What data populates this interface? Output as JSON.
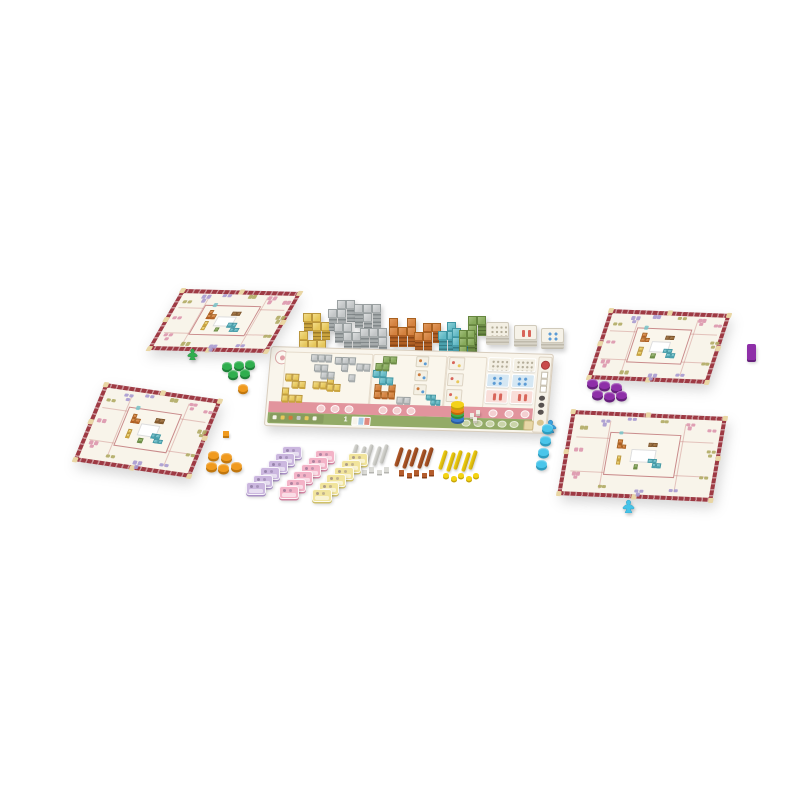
{
  "scene": {
    "background": "#ffffff"
  },
  "palette": {
    "gold": {
      "top": "#e7c75a",
      "light": "#f2dd8a",
      "edge": "#bb973d",
      "s1": "#caa43e",
      "s2": "#9a7a2a"
    },
    "gray": {
      "top": "#c3c6c7",
      "light": "#dcdedf",
      "edge": "#9aa0a1",
      "s1": "#a6abac",
      "s2": "#82888a"
    },
    "orange": {
      "top": "#d3813f",
      "light": "#e29a5e",
      "edge": "#a8601f",
      "s1": "#b05f24",
      "s2": "#8a4718"
    },
    "teal": {
      "top": "#62b9c5",
      "light": "#8ed0d8",
      "edge": "#3f96a3",
      "s1": "#4aa0ad",
      "s2": "#357d88"
    },
    "green": {
      "top": "#86a95b",
      "light": "#a3bf7d",
      "edge": "#66863f",
      "s1": "#6d8c46",
      "s2": "#536e33"
    },
    "brown": {
      "top": "#9a6b3a",
      "light": "#b08452",
      "edge": "#7a5026",
      "s1": "#83592c",
      "s2": "#6a4522"
    },
    "white": {
      "top": "#f2eee2",
      "light": "#faf7ef",
      "edge": "#d6cfbc",
      "s1": "#ddd6c4",
      "s2": "#c4bca8"
    }
  },
  "shapes": {
    "I2": [
      [
        0,
        0
      ],
      [
        1,
        0
      ]
    ],
    "I3": [
      [
        0,
        0
      ],
      [
        1,
        0
      ],
      [
        2,
        0
      ]
    ],
    "O1": [
      [
        0,
        0
      ]
    ],
    "V2": [
      [
        0,
        0
      ],
      [
        0,
        1
      ]
    ],
    "O4": [
      [
        0,
        0
      ],
      [
        1,
        0
      ],
      [
        0,
        1
      ],
      [
        1,
        1
      ]
    ],
    "S4": [
      [
        0,
        0
      ],
      [
        1,
        0
      ],
      [
        1,
        1
      ],
      [
        2,
        1
      ]
    ],
    "Z4": [
      [
        1,
        0
      ],
      [
        2,
        0
      ],
      [
        0,
        1
      ],
      [
        1,
        1
      ]
    ],
    "L4": [
      [
        0,
        0
      ],
      [
        0,
        1
      ],
      [
        1,
        1
      ],
      [
        2,
        1
      ]
    ],
    "J4": [
      [
        0,
        0
      ],
      [
        1,
        0
      ],
      [
        2,
        0
      ],
      [
        2,
        1
      ]
    ],
    "T4": [
      [
        0,
        0
      ],
      [
        1,
        0
      ],
      [
        2,
        0
      ],
      [
        1,
        1
      ]
    ],
    "U5": [
      [
        0,
        0
      ],
      [
        2,
        0
      ],
      [
        0,
        1
      ],
      [
        1,
        1
      ],
      [
        2,
        1
      ]
    ],
    "C3": [
      [
        0,
        0
      ],
      [
        0,
        1
      ],
      [
        1,
        1
      ]
    ],
    "C3b": [
      [
        1,
        0
      ],
      [
        0,
        1
      ],
      [
        1,
        1
      ]
    ],
    "P4": [
      [
        0,
        0
      ],
      [
        1,
        0
      ],
      [
        0,
        1
      ],
      [
        0,
        2
      ]
    ],
    "P5": [
      [
        0,
        0
      ],
      [
        1,
        0
      ],
      [
        0,
        1
      ],
      [
        1,
        1
      ],
      [
        0,
        2
      ]
    ]
  },
  "tile_stacks": [
    {
      "name": "gold-tile-stack",
      "color": "gold",
      "shape": "S4",
      "x": 303,
      "y": 313,
      "cell": 9,
      "side": 10
    },
    {
      "name": "gold-tile-stack",
      "color": "gold",
      "shape": "L4",
      "x": 299,
      "y": 331,
      "cell": 9,
      "side": 8
    },
    {
      "name": "gray-tile-stack",
      "color": "gray",
      "shape": "Z4",
      "x": 328,
      "y": 300,
      "cell": 9,
      "side": 14
    },
    {
      "name": "gray-tile-stack",
      "color": "gray",
      "shape": "T4",
      "x": 354,
      "y": 304,
      "cell": 9,
      "side": 16
    },
    {
      "name": "gray-tile-stack",
      "color": "gray",
      "shape": "S4",
      "x": 334,
      "y": 323,
      "cell": 9,
      "side": 12
    },
    {
      "name": "gray-tile-stack",
      "color": "gray",
      "shape": "J4",
      "x": 360,
      "y": 328,
      "cell": 9,
      "side": 12
    },
    {
      "name": "orange-tile-stack",
      "color": "orange",
      "shape": "U5",
      "x": 389,
      "y": 318,
      "cell": 9,
      "side": 12
    },
    {
      "name": "orange-tile-stack",
      "color": "orange",
      "shape": "Z4",
      "x": 414,
      "y": 323,
      "cell": 9,
      "side": 12
    },
    {
      "name": "teal-tile-stack",
      "color": "teal",
      "shape": "C3b",
      "x": 438,
      "y": 322,
      "cell": 9,
      "side": 12
    },
    {
      "name": "teal-tile-stack",
      "color": "teal",
      "shape": "C3",
      "x": 452,
      "y": 328,
      "cell": 9,
      "side": 10
    },
    {
      "name": "green-tile-stack",
      "color": "green",
      "shape": "P4",
      "x": 468,
      "y": 316,
      "cell": 9,
      "side": 12
    },
    {
      "name": "green-tile-stack",
      "color": "green",
      "shape": "P5",
      "x": 459,
      "y": 330,
      "cell": 8,
      "side": 9
    }
  ],
  "card_stacks": [
    {
      "name": "card-stack-dotted",
      "x": 486,
      "y": 322,
      "w": 23,
      "h": 15,
      "side": 9,
      "face": "#f3efe3",
      "icon": "dots",
      "icon_color": "#b3ac98"
    },
    {
      "name": "card-stack-red",
      "x": 514,
      "y": 325,
      "w": 23,
      "h": 15,
      "side": 8,
      "face": "#f6f2e8",
      "icon": "bars",
      "icon_color": "#d8655a"
    },
    {
      "name": "card-stack-blue",
      "x": 541,
      "y": 328,
      "w": 23,
      "h": 15,
      "side": 7,
      "face": "#f6f2e8",
      "icon": "pips",
      "icon_color": "#5b9bd5"
    }
  ],
  "main_board": {
    "card_label": "1",
    "pieces": [
      {
        "color": "gray",
        "shape": "I3",
        "x": 40,
        "y": 6
      },
      {
        "color": "gray",
        "shape": "T4",
        "x": 64,
        "y": 8
      },
      {
        "color": "gray",
        "shape": "S4",
        "x": 44,
        "y": 16
      },
      {
        "color": "gray",
        "shape": "I2",
        "x": 86,
        "y": 14
      },
      {
        "color": "gray",
        "shape": "O1",
        "x": 79,
        "y": 25
      },
      {
        "color": "gold",
        "shape": "S4",
        "x": 16,
        "y": 26
      },
      {
        "color": "gold",
        "shape": "L4",
        "x": 14,
        "y": 40
      },
      {
        "color": "gold",
        "shape": "I2",
        "x": 44,
        "y": 33
      },
      {
        "color": "gold",
        "shape": "C3",
        "x": 58,
        "y": 28
      },
      {
        "color": "green",
        "shape": "Z4",
        "x": 105,
        "y": 6
      },
      {
        "color": "teal",
        "shape": "S4",
        "x": 103,
        "y": 20
      },
      {
        "color": "orange",
        "shape": "U5",
        "x": 106,
        "y": 34
      },
      {
        "color": "gray",
        "shape": "I2",
        "x": 129,
        "y": 46
      },
      {
        "color": "teal",
        "shape": "S4",
        "x": 158,
        "y": 43,
        "cell": 5
      }
    ],
    "white_tiles": [
      {
        "x": 145,
        "y": 5
      },
      {
        "x": 145,
        "y": 19
      },
      {
        "x": 145,
        "y": 33
      }
    ],
    "mini_cards": [
      {
        "y": 5
      },
      {
        "y": 21
      },
      {
        "y": 37
      }
    ],
    "card_grid_rows": [
      {
        "bg": "#f3efe3",
        "icon": "dots",
        "ic": "#b3ac98"
      },
      {
        "bg": "#d5e7f3",
        "icon": "pips",
        "ic": "#5b9bd5"
      },
      {
        "bg": "#f9ded9",
        "icon": "bars",
        "ic": "#d8655a"
      }
    ],
    "pink_circle_groups": [
      [
        50,
        64,
        78
      ],
      [
        112,
        126,
        140
      ],
      [
        222,
        238,
        254
      ]
    ],
    "green_circles": [
      196,
      208,
      220,
      232,
      244
    ],
    "mini_card_colors": [
      "#f7f4ea",
      "#a9cde8",
      "#e08a80"
    ],
    "left_chip_colors": [
      "#f7f4ea",
      "#e7c75a",
      "#cd7a3c",
      "#c3c6c7",
      "#e7c75a",
      "#f7f4ea"
    ]
  },
  "player_boards": [
    {
      "id": "board-tl",
      "name": "player-board-top-left"
    },
    {
      "id": "board-bl",
      "name": "player-board-bottom-left"
    },
    {
      "id": "board-tr",
      "name": "player-board-top-right"
    },
    {
      "id": "board-br",
      "name": "player-board-bottom-right"
    }
  ],
  "board_frame": {
    "border_color": "#9e3a44",
    "inner_color": "#f8f4ea",
    "notch_color": "#e9d6a4",
    "line_color": "rgba(190,100,100,0.35)",
    "center_border": "#c98b8b",
    "cluster_colors": {
      "purple": "#a79ad0",
      "olive": "#b0ab64",
      "pink": "#dc96ad",
      "teal": "#7bc3c9"
    },
    "clusters": [
      {
        "x": 7,
        "y": 18,
        "c": "olive",
        "n": 2
      },
      {
        "x": 20,
        "y": 9,
        "c": "purple",
        "n": 3
      },
      {
        "x": 37,
        "y": 6,
        "c": "purple",
        "n": 2
      },
      {
        "x": 58,
        "y": 7,
        "c": "olive",
        "n": 2
      },
      {
        "x": 75,
        "y": 9,
        "c": "pink",
        "n": 3
      },
      {
        "x": 89,
        "y": 15,
        "c": "pink",
        "n": 2
      },
      {
        "x": 6,
        "y": 44,
        "c": "pink",
        "n": 2
      },
      {
        "x": 91,
        "y": 40,
        "c": "olive",
        "n": 3
      },
      {
        "x": 7,
        "y": 72,
        "c": "pink",
        "n": 3
      },
      {
        "x": 25,
        "y": 86,
        "c": "olive",
        "n": 2
      },
      {
        "x": 49,
        "y": 89,
        "c": "purple",
        "n": 3
      },
      {
        "x": 71,
        "y": 87,
        "c": "purple",
        "n": 2
      },
      {
        "x": 89,
        "y": 70,
        "c": "olive",
        "n": 2
      },
      {
        "x": 33,
        "y": 22,
        "c": "teal",
        "n": 1
      }
    ],
    "glyphs": [
      {
        "c": "orange",
        "shape": "C3",
        "x": 12,
        "y": 14
      },
      {
        "c": "brown",
        "shape": "I2",
        "x": 56,
        "y": 18
      },
      {
        "c": "teal",
        "shape": "S4",
        "x": 60,
        "y": 58
      },
      {
        "c": "gold",
        "shape": "V2",
        "x": 14,
        "y": 54
      },
      {
        "c": "green",
        "shape": "O1",
        "x": 40,
        "y": 74
      }
    ]
  },
  "fans": [
    {
      "name": "lavender-token-fan",
      "x": 246,
      "y": 482,
      "count": 6,
      "dx": 7.2,
      "dy": -7.3,
      "c": "#cbb7df",
      "side": "#a88fc4"
    },
    {
      "name": "pink-token-fan",
      "x": 279,
      "y": 486,
      "count": 6,
      "dx": 7.2,
      "dy": -7.3,
      "c": "#f3b3c7",
      "side": "#d184a2"
    },
    {
      "name": "yellow-token-fan",
      "x": 312,
      "y": 489,
      "count": 6,
      "dx": 7.2,
      "dy": -7.3,
      "c": "#f1e49c",
      "side": "#cfc06a"
    }
  ],
  "stick_groups": [
    {
      "name": "white-stick-group",
      "x": 352,
      "y": 444,
      "sticks": 5,
      "c": "#dbdbd6",
      "d": "#b5b5b0",
      "bit": "cube",
      "bits": 5
    },
    {
      "name": "brown-stick-group",
      "x": 397,
      "y": 447,
      "sticks": 5,
      "c": "#b45c2c",
      "d": "#8a4018",
      "bit": "cube",
      "bits": 5
    },
    {
      "name": "yellow-stick-group",
      "x": 441,
      "y": 450,
      "sticks": 5,
      "c": "#f4d414",
      "d": "#c7a50a",
      "bit": "disc",
      "bits": 5
    }
  ],
  "tokens": [
    {
      "type": "meeple",
      "name": "green-meeple",
      "c": "#2fae4e",
      "d": "#1e8038",
      "x": 186,
      "y": 347,
      "w": 13
    },
    {
      "type": "disc",
      "name": "green-disc",
      "c": "#2fae4e",
      "d": "#1e8038",
      "r": 5,
      "pts": [
        [
          227,
          366
        ],
        [
          239,
          365
        ],
        [
          250,
          364
        ],
        [
          233,
          374
        ],
        [
          245,
          373
        ]
      ]
    },
    {
      "type": "disc",
      "name": "orange-disc",
      "c": "#f09a1e",
      "d": "#c1770e",
      "r": 5,
      "pts": [
        [
          243,
          388
        ]
      ]
    },
    {
      "type": "cube",
      "name": "orange-cube",
      "c": "#f09a1e",
      "d": "#c1770e",
      "s": 6,
      "pts": [
        [
          223,
          431
        ]
      ]
    },
    {
      "type": "disc",
      "name": "orange-disc",
      "c": "#f09a1e",
      "d": "#c1770e",
      "r": 5.5,
      "pts": [
        [
          213,
          455
        ],
        [
          226,
          457
        ],
        [
          211,
          466
        ],
        [
          223,
          468
        ],
        [
          236,
          466
        ]
      ]
    },
    {
      "type": "disc",
      "name": "purple-disc",
      "c": "#8e2fa8",
      "d": "#66207c",
      "r": 5.5,
      "pts": [
        [
          592,
          383
        ],
        [
          604,
          385
        ],
        [
          616,
          387
        ],
        [
          597,
          394
        ],
        [
          609,
          396
        ],
        [
          621,
          395
        ]
      ]
    },
    {
      "type": "bar",
      "name": "purple-rect-token",
      "c": "#8e2fa8",
      "d": "#66207c",
      "x": 747,
      "y": 344,
      "w": 9,
      "h": 16
    },
    {
      "type": "meeple",
      "name": "blue-meeple",
      "c": "#3aa0dc",
      "d": "#2678ab",
      "x": 543,
      "y": 419,
      "w": 15
    },
    {
      "type": "disc",
      "name": "cyan-disc",
      "c": "#49c5ea",
      "d": "#2d9cbf",
      "r": 5.5,
      "pts": [
        [
          547,
          428
        ],
        [
          545,
          440
        ],
        [
          543,
          452
        ],
        [
          541,
          464
        ]
      ]
    },
    {
      "type": "meeple",
      "name": "cyan-meeple",
      "c": "#45c3e8",
      "d": "#2d9cbf",
      "x": 621,
      "y": 499,
      "w": 15
    },
    {
      "type": "discstack",
      "name": "rainbow-disc-stack",
      "x": 457,
      "y": 401,
      "r": 6.5,
      "colors": [
        "#f4d21a",
        "#f08c1a",
        "#3fae4c",
        "#3a7bd0"
      ],
      "sides": [
        "#c7a50a",
        "#c2680a",
        "#2d8a3a",
        "#2a5da0"
      ]
    },
    {
      "type": "cube",
      "name": "white-bit",
      "c": "#efece4",
      "d": "#c9c4b6",
      "s": 4,
      "pts": [
        [
          470,
          413
        ],
        [
          476,
          410
        ],
        [
          473,
          417
        ]
      ]
    }
  ]
}
